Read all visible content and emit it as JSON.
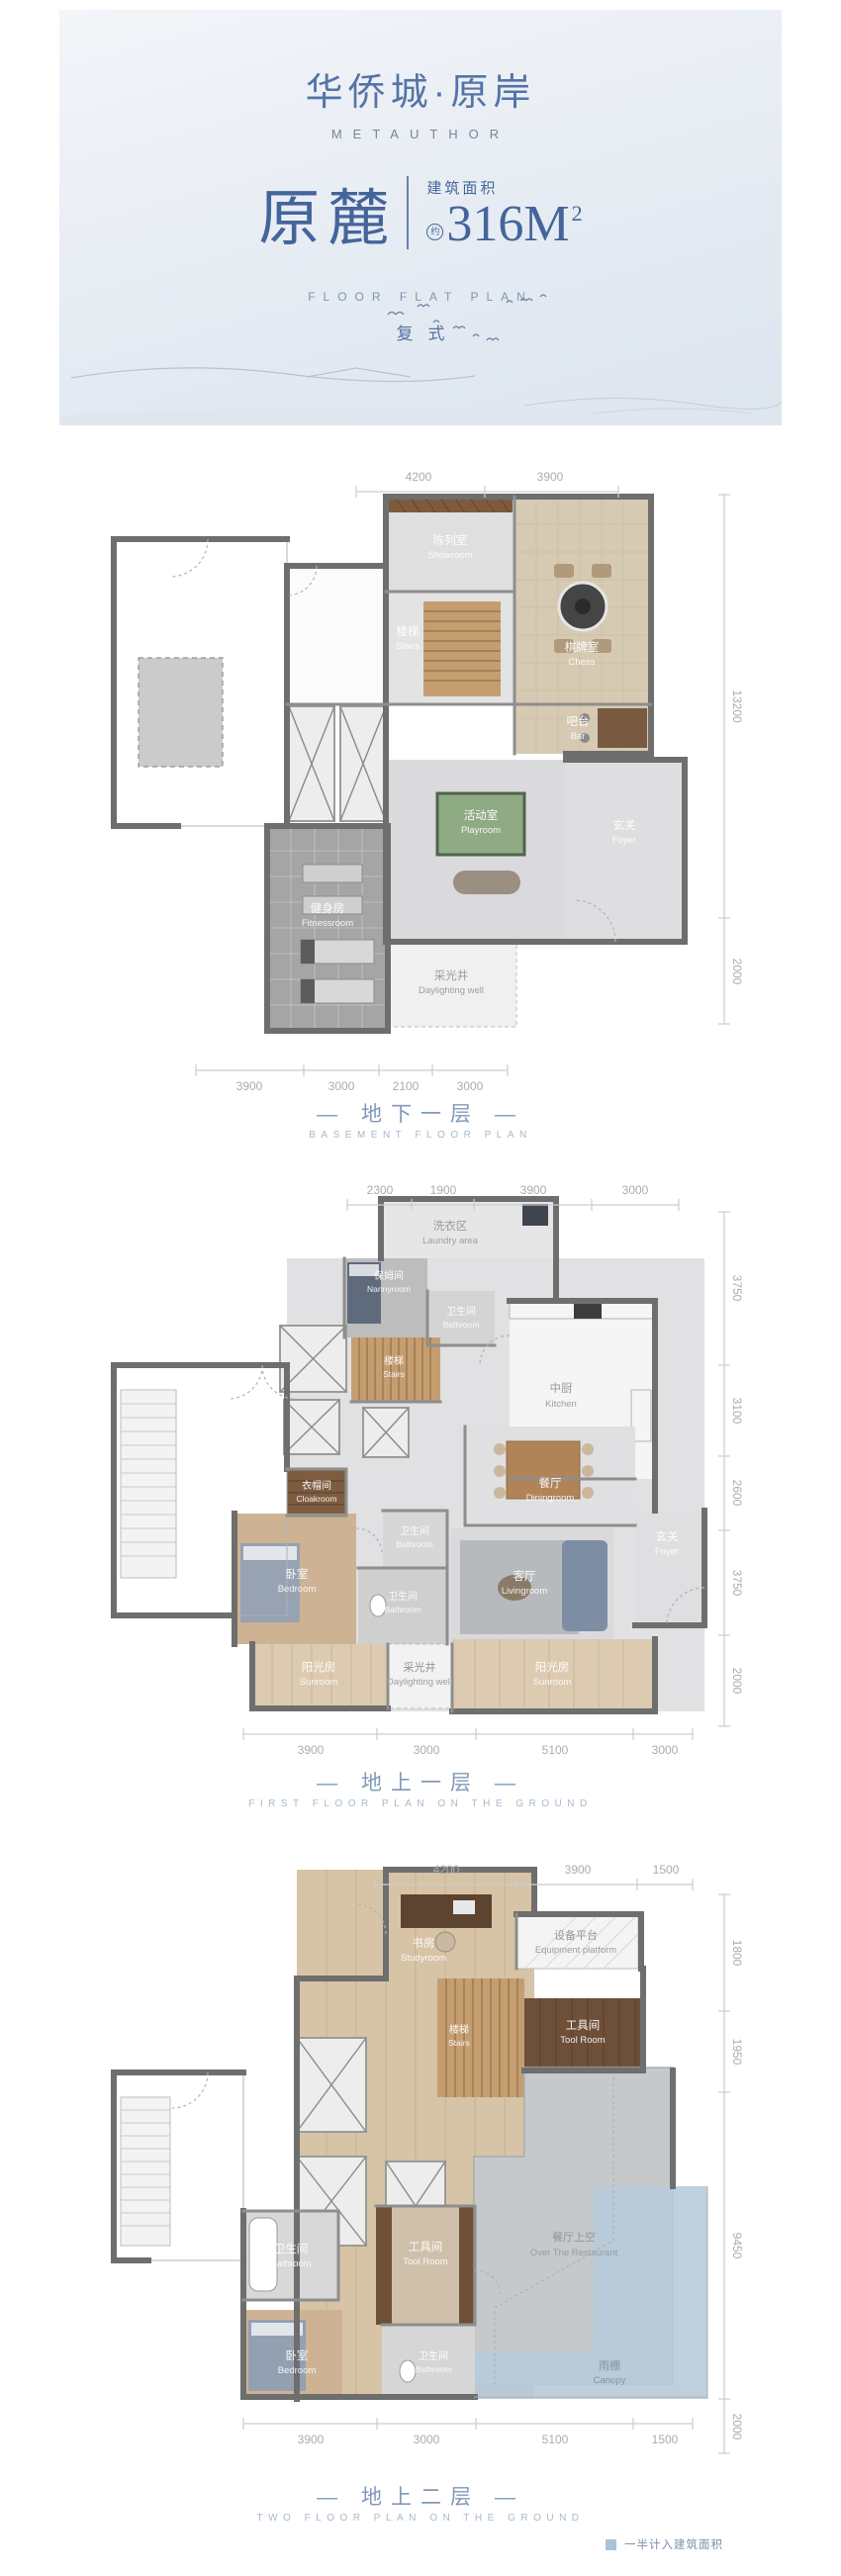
{
  "header": {
    "logo_cn": "华侨城·原岸",
    "logo_en": "METAUTHOR",
    "unit_name": "原麓",
    "area_label": "建筑面积",
    "area_approx": "约",
    "area_value": "316M",
    "area_sup": "2",
    "plan_en": "FLOOR FLAT PLAN",
    "plan_type": "复式"
  },
  "colors": {
    "title_blue": "#44659b",
    "caption_blue": "#7f99b8",
    "wall_gray": "#6e6e6e",
    "canopy_blue": "#b7cada",
    "legend_swatch": "#a9c3da"
  },
  "plans": [
    {
      "caption_cn": "— 地下一层 —",
      "caption_en": "BASEMENT FLOOR PLAN",
      "dims_top": [
        "4200",
        "3900"
      ],
      "dims_right": [
        "13200",
        "2000"
      ],
      "dims_bottom": [
        "3900",
        "3000",
        "2100",
        "3000"
      ],
      "rooms": {
        "showroom": {
          "cn": "陈列室",
          "en": "Showroom"
        },
        "chess": {
          "cn": "棋牌室",
          "en": "Chess"
        },
        "stairs": {
          "cn": "楼梯",
          "en": "Stairs"
        },
        "bar": {
          "cn": "吧台",
          "en": "Bar"
        },
        "playroom": {
          "cn": "活动室",
          "en": "Playroom"
        },
        "foyer": {
          "cn": "玄关",
          "en": "Foyer"
        },
        "fitness": {
          "cn": "健身房",
          "en": "Fitnessroom"
        },
        "daylight": {
          "cn": "采光井",
          "en": "Daylighting well"
        }
      }
    },
    {
      "caption_cn": "— 地上一层 —",
      "caption_en": "FIRST FLOOR PLAN ON THE GROUND",
      "dims_top": [
        "2300",
        "1900",
        "3900",
        "3000"
      ],
      "dims_right": [
        "3750",
        "3100",
        "2600",
        "3750",
        "2000"
      ],
      "dims_bottom": [
        "3900",
        "3000",
        "5100",
        "3000"
      ],
      "rooms": {
        "laundry": {
          "cn": "洗衣区",
          "en": "Laundry area"
        },
        "nanny": {
          "cn": "保姆间",
          "en": "Nannyroom"
        },
        "bath_top": {
          "cn": "卫生间",
          "en": "Bathroom"
        },
        "kitchen": {
          "cn": "中厨",
          "en": "Kitchen"
        },
        "stairs": {
          "cn": "楼梯",
          "en": "Stairs"
        },
        "cloak": {
          "cn": "衣帽间",
          "en": "Cloakroom"
        },
        "dining": {
          "cn": "餐厅",
          "en": "Diningroom"
        },
        "foyer": {
          "cn": "玄关",
          "en": "Foyer"
        },
        "bedroom": {
          "cn": "卧室",
          "en": "Bedroom"
        },
        "bath_mid": {
          "cn": "卫生间",
          "en": "Bathroom"
        },
        "bath_low": {
          "cn": "卫生间",
          "en": "Bathroom"
        },
        "living": {
          "cn": "客厅",
          "en": "Livingroom"
        },
        "sunroom_left": {
          "cn": "阳光房",
          "en": "Sunroom"
        },
        "daylight": {
          "cn": "采光井",
          "en": "Daylighting well"
        },
        "sunroom_right": {
          "cn": "阳光房",
          "en": "Sunroom"
        }
      }
    },
    {
      "caption_cn": "— 地上二层 —",
      "caption_en": "TWO FLOOR PLAN ON THE GROUND",
      "dims_top": [
        "4200",
        "3900",
        "1500"
      ],
      "dims_right": [
        "1800",
        "1950",
        "9450",
        "2000"
      ],
      "dims_bottom": [
        "3900",
        "3000",
        "5100",
        "1500"
      ],
      "rooms": {
        "study": {
          "cn": "书房",
          "en": "Studyroom"
        },
        "equipment": {
          "cn": "设备平台",
          "en": "Equipment platform"
        },
        "tool_top": {
          "cn": "工具间",
          "en": "Tool Room"
        },
        "stairs": {
          "cn": "楼梯",
          "en": "Stairs"
        },
        "bath_up": {
          "cn": "卫生间",
          "en": "Bathroom"
        },
        "tool_mid": {
          "cn": "工具间",
          "en": "Tool Room"
        },
        "over_restaurant": {
          "cn": "餐厅上空",
          "en": "Over The Restaurant"
        },
        "bath_low": {
          "cn": "卫生间",
          "en": "Bathroom"
        },
        "bedroom": {
          "cn": "卧室",
          "en": "Bedroom"
        },
        "canopy": {
          "cn": "雨棚",
          "en": "Canopy"
        }
      }
    }
  ],
  "legend": {
    "label": "一半计入建筑面积"
  }
}
